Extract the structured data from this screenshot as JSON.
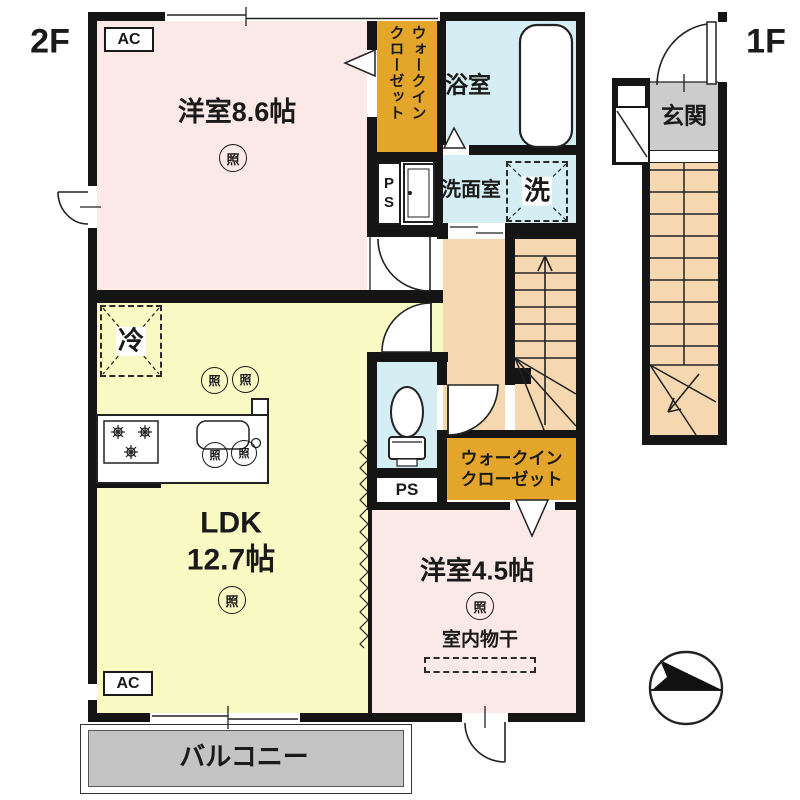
{
  "labels": {
    "floor2": "2F",
    "floor1": "1F"
  },
  "rooms": {
    "bedroom86": "洋室8.6帖",
    "ldk_line1": "LDK",
    "ldk_line2": "12.7帖",
    "bedroom45": "洋室4.5帖",
    "indoor_drying": "室内物干",
    "bath": "浴室",
    "washroom": "洗面室",
    "balcony": "バルコニー",
    "genkan": "玄関",
    "wic_col1": "ウォークイン",
    "wic_col2": "クローゼット",
    "wic2_line1": "ウォークイン",
    "wic2_line2": "クローゼット"
  },
  "symbols": {
    "ac": "AC",
    "ps": "PS",
    "light": "照",
    "fridge": "冷",
    "washer": "洗"
  },
  "colors": {
    "wall": "#151515",
    "room_pink": "#fbe9e8",
    "room_yellow": "#f9f9c3",
    "room_blue": "#d5eef3",
    "closet_orange": "#e4a62a",
    "stair_peach": "#f6d8b0",
    "balcony_gray": "#c4c4c4",
    "genkan_gray": "#cccccc"
  }
}
